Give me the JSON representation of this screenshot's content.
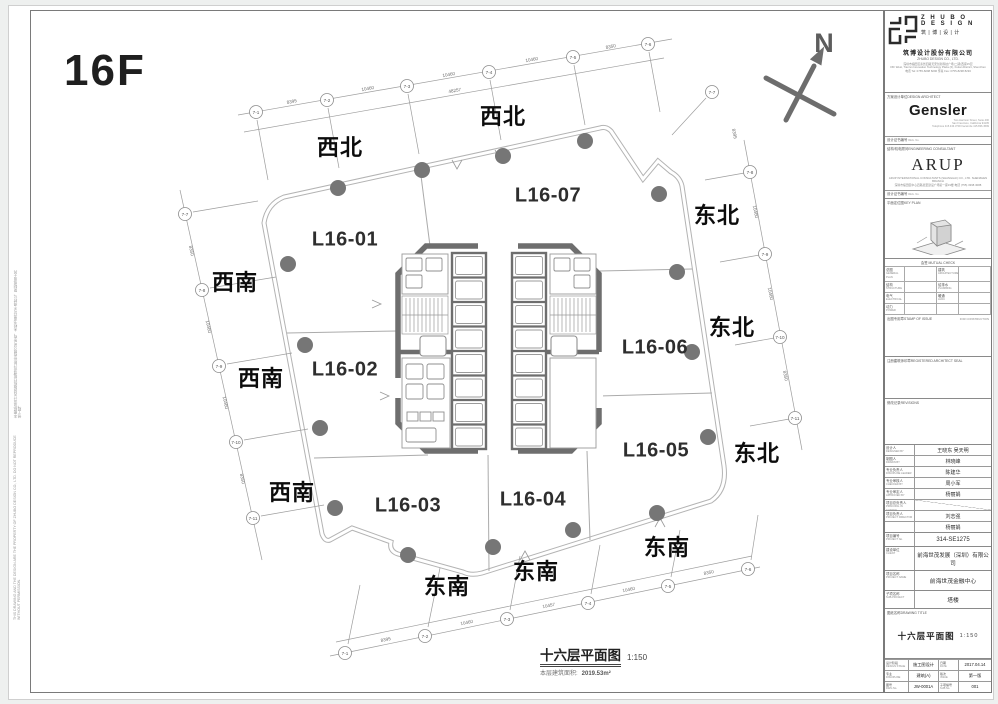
{
  "sheet": {
    "floor_label": "16F",
    "north_label": "N"
  },
  "plan": {
    "units": [
      "L16-01",
      "L16-02",
      "L16-03",
      "L16-04",
      "L16-05",
      "L16-06",
      "L16-07"
    ],
    "directions": [
      "西北",
      "西北",
      "东北",
      "东北",
      "东北",
      "西南",
      "西南",
      "西南",
      "东南",
      "东南",
      "东南"
    ],
    "caption_title": "十六层平面图",
    "caption_scale": "1:150",
    "caption_area_label": "本层建筑面积:",
    "caption_area_value": "2019.53m²",
    "bubbles_top": [
      "7-1",
      "7-2",
      "7-3",
      "7-4",
      "7-5",
      "7-6"
    ],
    "bubbles_bottom": [
      "7-1",
      "7-2",
      "7-3",
      "7-4",
      "7-5",
      "7-6"
    ],
    "bubbles_left": [
      "7-7",
      "7-8",
      "7-9",
      "7-10",
      "7-11"
    ],
    "bubbles_right": [
      "7-7",
      "7-8",
      "7-9",
      "7-10",
      "7-11"
    ],
    "dims_top": [
      "8395",
      "10460",
      "10460",
      "10460",
      "8350"
    ],
    "dims_top_overall": "48257",
    "dims_bottom": [
      "8395",
      "10460",
      "10457",
      "10460",
      "8350"
    ],
    "dims_left": [
      "8350",
      "10460",
      "10460",
      "8350"
    ],
    "dims_right": [
      "8395",
      "10460",
      "10460",
      "8350"
    ]
  },
  "margin": {
    "note_cn": "本图纸及设计内容版权归筑博设计股份有限公司所有，未经书面许可不得转让、复制或用于其他工程。",
    "note_en": "THIS DRAWING AND THE DESIGN ARE THE PROPERTY OF ZHUBO DESIGN CO., LTD. DO NOT REPRODUCE WITHOUT PERMISSION."
  },
  "titleblock": {
    "zhubo": {
      "wordmark1": "Z H U B O",
      "wordmark2": "D E S I G N",
      "wordmark_cn": "筑 | 博 | 设 | 计",
      "company_cn": "筑博设计股份有限公司",
      "company_en": "ZHUBO DESIGN CO., LTD.",
      "addr1": "深圳市福田区泰然四路天安创新科技广场(二期)西座15层",
      "addr2": "15F West, Tian'an Innovation Technology Plaza (II), Futian District, Shenzhen",
      "addr3": "电话 Tel: 0755-8298 8296  传真 Fax: 0755-8298 8293"
    },
    "gensler": {
      "role_cn": "方案设计单位",
      "role_en": "DESIGN ARCHITECT",
      "logo": "Gensler",
      "addr1": "Two Harrison Street, Suite 400",
      "addr2": "San Francisco, California 94105",
      "addr3": "Telephone 415.433.3700  Facsimile 415.836.4599",
      "cert_cn": "设计证书编号",
      "cert_en": "REG. No."
    },
    "arup": {
      "role_cn": "结构/机电顾问",
      "role_en": "ENGINEERING CONSULTANT",
      "logo": "ARUP",
      "addr1": "ARUP INTERNATIONAL CONSULTANTS (SHANGHAI) CO., LTD. SHENZHEN BRANCH",
      "addr2": "深圳市福田区中心四路嘉里建设广场第一座19楼  电话 (755) 3398 3088",
      "cert_cn": "设计证书编号",
      "cert_en": "REG. No."
    },
    "keyplan": {
      "label_cn": "平面定位图",
      "label_en": "KEY PLAN"
    },
    "signoff": {
      "header": "会签 MUTUAL CHECK",
      "r1a": "总图",
      "r1a_en": "GENERAL PLAN",
      "r1b": "建筑",
      "r1b_en": "ARCHITECTURE",
      "r2a": "结构",
      "r2a_en": "STRUCTURE",
      "r2b": "给排水",
      "r2b_en": "PLUMBING",
      "r3a": "电气",
      "r3a_en": "ELECTRICAL",
      "r3b": "暖通",
      "r3b_en": "HVAC",
      "r4a": "动力",
      "r4a_en": "POWER",
      "r4b": "",
      "r4b_en": ""
    },
    "stamp": {
      "label_cn": "出图专用章",
      "label_en": "STAMP OF ISSUE",
      "note": "FOR CONSTRUCTION"
    },
    "registration": {
      "label_cn": "注册建筑师印章",
      "label_en": "REGISTERED ARCHITECT SEAL"
    },
    "revision": {
      "label_cn": "修改记录",
      "label_en": "REVISIONS"
    },
    "signatures": [
      {
        "cn": "设计人",
        "en": "DESIGNED BY",
        "v": "王晓东  吴天明"
      },
      {
        "cn": "制图人",
        "en": "DRAWN BY",
        "v": "林晓峰"
      },
      {
        "cn": "专业负责人",
        "en": "DISCIPLINE LEADER",
        "v": "陈建华"
      },
      {
        "cn": "专业审核人",
        "en": "CHECKED BY",
        "v": "周小军"
      },
      {
        "cn": "专业审定人",
        "en": "APPROVED BY",
        "v": "杨丽娟"
      },
      {
        "cn": "项目总负责人",
        "en": "PRINCIPAL IN CHARGE",
        "v": ""
      },
      {
        "cn": "项目负责人",
        "en": "PROJECT DIRECTOR",
        "v": "刘志强"
      },
      {
        "cn": "",
        "en": "",
        "v": "杨丽娟"
      }
    ],
    "project_no": {
      "cn": "项目编号",
      "en": "PROJECT No.",
      "v": "314-SE1275"
    },
    "client": {
      "cn": "建设单位",
      "en": "CLIENT",
      "v": "前海世茂发展（深圳）有限公司"
    },
    "project": {
      "cn": "项目名称",
      "en": "PROJECT NAME",
      "v": "前海世茂金融中心"
    },
    "subproject": {
      "cn": "子项名称",
      "en": "SUB-PROJECT",
      "v": "塔楼"
    },
    "sheet_title": {
      "cn": "图纸名称",
      "en": "DRAWING TITLE",
      "v": "十六层平面图",
      "scale": "1:150"
    },
    "grid": {
      "r1c1": "设计阶段",
      "r1c1e": "DESIGN STAGE",
      "r1c2": "施工图设计",
      "r1c3": "日期",
      "r1c3e": "DATE",
      "r1c4": "2017.04.14",
      "r2c1": "专业",
      "r2c1e": "DISCIPLINE",
      "r2c2": "建筑(A)",
      "r2c3": "版次",
      "r2c3e": "ISSUE",
      "r2c4": "第一版",
      "r3c1": "图号",
      "r3c1e": "DWG No.",
      "r3c2": "JW-0001A",
      "r3c3": "子项编号",
      "r3c3e": "SUB No.",
      "r3c4": "001"
    }
  }
}
